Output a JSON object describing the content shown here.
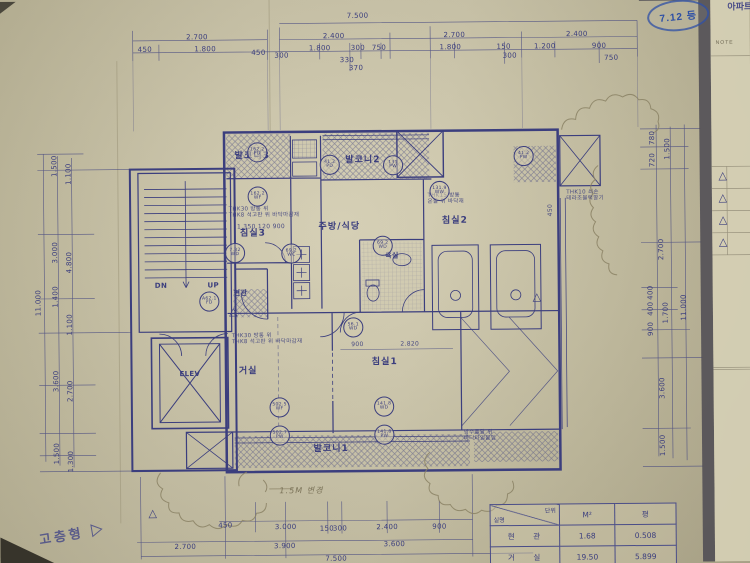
{
  "colors": {
    "ink": "#3b3e7e",
    "paper": "#c9c2a4",
    "stamp_blue": "#2d4fa5",
    "pencil": "#7c745a"
  },
  "stamp": {
    "text": "7.12 등"
  },
  "corner_header": {
    "text": "아파트"
  },
  "margin": {
    "note": "NOTE"
  },
  "type_label": {
    "text": "고층형 ▷"
  },
  "area_table": {
    "header": {
      "diag_top": "단위",
      "diag_bottom": "실명",
      "col_m2": "M²",
      "col_pyeong": "평"
    },
    "rows": [
      {
        "name": "현 관",
        "m2": "1.68",
        "pyeong": "0.508"
      },
      {
        "name": "거 실",
        "m2": "19.50",
        "pyeong": "5.899"
      }
    ]
  },
  "annotations": {
    "dims": [
      {
        "t": "7.500",
        "x": 360,
        "y": 17
      },
      {
        "t": "2.700",
        "x": 200,
        "y": 37
      },
      {
        "t": "2.400",
        "x": 336,
        "y": 37
      },
      {
        "t": "2.700",
        "x": 456,
        "y": 37
      },
      {
        "t": "2.400",
        "x": 578,
        "y": 37
      },
      {
        "t": "450",
        "x": 148,
        "y": 49
      },
      {
        "t": "1.800",
        "x": 208,
        "y": 49
      },
      {
        "t": "450",
        "x": 261,
        "y": 53
      },
      {
        "t": "300",
        "x": 284,
        "y": 56
      },
      {
        "t": "1.800",
        "x": 322,
        "y": 49
      },
      {
        "t": "300",
        "x": 360,
        "y": 49
      },
      {
        "t": "750",
        "x": 381,
        "y": 49
      },
      {
        "t": "1.800",
        "x": 452,
        "y": 49
      },
      {
        "t": "150",
        "x": 505,
        "y": 49
      },
      {
        "t": "300",
        "x": 511,
        "y": 58
      },
      {
        "t": "1.200",
        "x": 546,
        "y": 49
      },
      {
        "t": "900",
        "x": 600,
        "y": 49
      },
      {
        "t": "330",
        "x": 349,
        "y": 61
      },
      {
        "t": "370",
        "x": 358,
        "y": 69
      },
      {
        "t": "750",
        "x": 612,
        "y": 61
      },
      {
        "t": "11.000",
        "x": 40,
        "y": 300,
        "r": -90
      },
      {
        "t": "1.500",
        "x": 57,
        "y": 164,
        "r": -90
      },
      {
        "t": "1.100",
        "x": 71,
        "y": 172,
        "r": -90
      },
      {
        "t": "3.000",
        "x": 57,
        "y": 250,
        "r": -90
      },
      {
        "t": "4.800",
        "x": 71,
        "y": 260,
        "r": -90
      },
      {
        "t": "1.400",
        "x": 57,
        "y": 294,
        "r": -90
      },
      {
        "t": "1.100",
        "x": 71,
        "y": 322,
        "r": -90
      },
      {
        "t": "3.600",
        "x": 57,
        "y": 378,
        "r": -90
      },
      {
        "t": "2.700",
        "x": 71,
        "y": 388,
        "r": -90
      },
      {
        "t": "1.500",
        "x": 57,
        "y": 450,
        "r": -90
      },
      {
        "t": "1.300",
        "x": 71,
        "y": 458,
        "r": -90
      },
      {
        "t": "780",
        "x": 652,
        "y": 141,
        "r": -90
      },
      {
        "t": "720",
        "x": 652,
        "y": 163,
        "r": -90
      },
      {
        "t": "1.500",
        "x": 667,
        "y": 152,
        "r": -90
      },
      {
        "t": "2.700",
        "x": 660,
        "y": 252,
        "r": -90
      },
      {
        "t": "400",
        "x": 649,
        "y": 295,
        "r": -90
      },
      {
        "t": "400",
        "x": 649,
        "y": 311,
        "r": -90
      },
      {
        "t": "900",
        "x": 649,
        "y": 331,
        "r": -90
      },
      {
        "t": "1.700",
        "x": 664,
        "y": 315,
        "r": -90
      },
      {
        "t": "11.000",
        "x": 682,
        "y": 310,
        "r": -90
      },
      {
        "t": "3.600",
        "x": 660,
        "y": 390,
        "r": -90
      },
      {
        "t": "1.500",
        "x": 660,
        "y": 447,
        "r": -90
      },
      {
        "t": "450",
        "x": 224,
        "y": 523
      },
      {
        "t": "3.000",
        "x": 284,
        "y": 525
      },
      {
        "t": "150",
        "x": 325,
        "y": 527
      },
      {
        "t": "300",
        "x": 338,
        "y": 527
      },
      {
        "t": "2.400",
        "x": 385,
        "y": 526
      },
      {
        "t": "900",
        "x": 437,
        "y": 526
      },
      {
        "t": "2.700",
        "x": 184,
        "y": 544
      },
      {
        "t": "3.900",
        "x": 283,
        "y": 544
      },
      {
        "t": "3.600",
        "x": 392,
        "y": 543
      },
      {
        "t": "7.500",
        "x": 334,
        "y": 557
      }
    ],
    "interior_dims": [
      {
        "t": "1.350  120  900",
        "x": 262,
        "y": 227
      },
      {
        "t": "900",
        "x": 357,
        "y": 345
      },
      {
        "t": "2.820",
        "x": 409,
        "y": 345
      },
      {
        "t": "450",
        "x": 551,
        "y": 212,
        "r": -90
      }
    ],
    "rooms": [
      {
        "t": "발코니3",
        "x": 254,
        "y": 156
      },
      {
        "t": "침실3",
        "x": 254,
        "y": 233
      },
      {
        "t": "발코니2",
        "x": 364,
        "y": 161
      },
      {
        "t": "주방/식당",
        "x": 340,
        "y": 227
      },
      {
        "t": "침실2",
        "x": 455,
        "y": 222
      },
      {
        "t": "침실1",
        "x": 384,
        "y": 362
      },
      {
        "t": "거실",
        "x": 248,
        "y": 370
      },
      {
        "t": "발코니1",
        "x": 330,
        "y": 448
      }
    ],
    "small_rooms": [
      {
        "t": "욕실",
        "x": 392,
        "y": 256
      },
      {
        "t": "현관",
        "x": 241,
        "y": 292
      },
      {
        "t": "ELEV",
        "x": 190,
        "y": 372
      },
      {
        "t": "DN",
        "x": 162,
        "y": 284
      },
      {
        "t": "UP",
        "x": 214,
        "y": 284
      }
    ],
    "notes": [
      {
        "t": "THK30 방통 위\nTHK8 석고판 위 바닥마감재",
        "x": 230,
        "y": 212
      },
      {
        "t": "THK15 방통\n온돌 위 바닥재",
        "x": 428,
        "y": 200
      },
      {
        "t": "THK10 쇠손\n테라조블럭깔기",
        "x": 566,
        "y": 198
      },
      {
        "t": "THK30 방통 위\nTHK8 석고판 위 바닥마감재",
        "x": 232,
        "y": 338
      },
      {
        "t": "방수몰탈 위\n바닥타일붙임",
        "x": 462,
        "y": 436
      }
    ],
    "pencil_notes": [
      {
        "t": "1.5M 변경",
        "x": 300,
        "y": 489
      }
    ],
    "tags": [
      {
        "t": "162.2\nPD",
        "x": 259,
        "y": 152
      },
      {
        "t": "162.2\nWF",
        "x": 259,
        "y": 196
      },
      {
        "t": "41.2\nPD",
        "x": 331,
        "y": 165
      },
      {
        "t": "131\nPW",
        "x": 394,
        "y": 166
      },
      {
        "t": "41.2\nPW",
        "x": 524,
        "y": 158
      },
      {
        "t": "131.9\nWW",
        "x": 440,
        "y": 192
      },
      {
        "t": "69.2\nWD",
        "x": 383,
        "y": 246
      },
      {
        "t": "69.2\nWC",
        "x": 292,
        "y": 253
      },
      {
        "t": "7.32\nWD",
        "x": 236,
        "y": 252
      },
      {
        "t": "A62.1\nFD",
        "x": 210,
        "y": 300
      },
      {
        "t": "56.1\nWD",
        "x": 353,
        "y": 327
      },
      {
        "t": "502.5\nWF",
        "x": 279,
        "y": 406
      },
      {
        "t": "141.8\nWD",
        "x": 383,
        "y": 406
      },
      {
        "t": "502.7\nPW",
        "x": 279,
        "y": 434
      },
      {
        "t": "141.8\nPW",
        "x": 383,
        "y": 434
      }
    ],
    "markers": [
      {
        "t": "△",
        "x": 234,
        "y": 311
      },
      {
        "t": "△",
        "x": 536,
        "y": 299
      },
      {
        "t": "△",
        "x": 152,
        "y": 511
      },
      {
        "t": "△",
        "x": 722,
        "y": 180
      },
      {
        "t": "△",
        "x": 722,
        "y": 202
      },
      {
        "t": "△",
        "x": 722,
        "y": 224
      },
      {
        "t": "△",
        "x": 722,
        "y": 246
      }
    ]
  }
}
